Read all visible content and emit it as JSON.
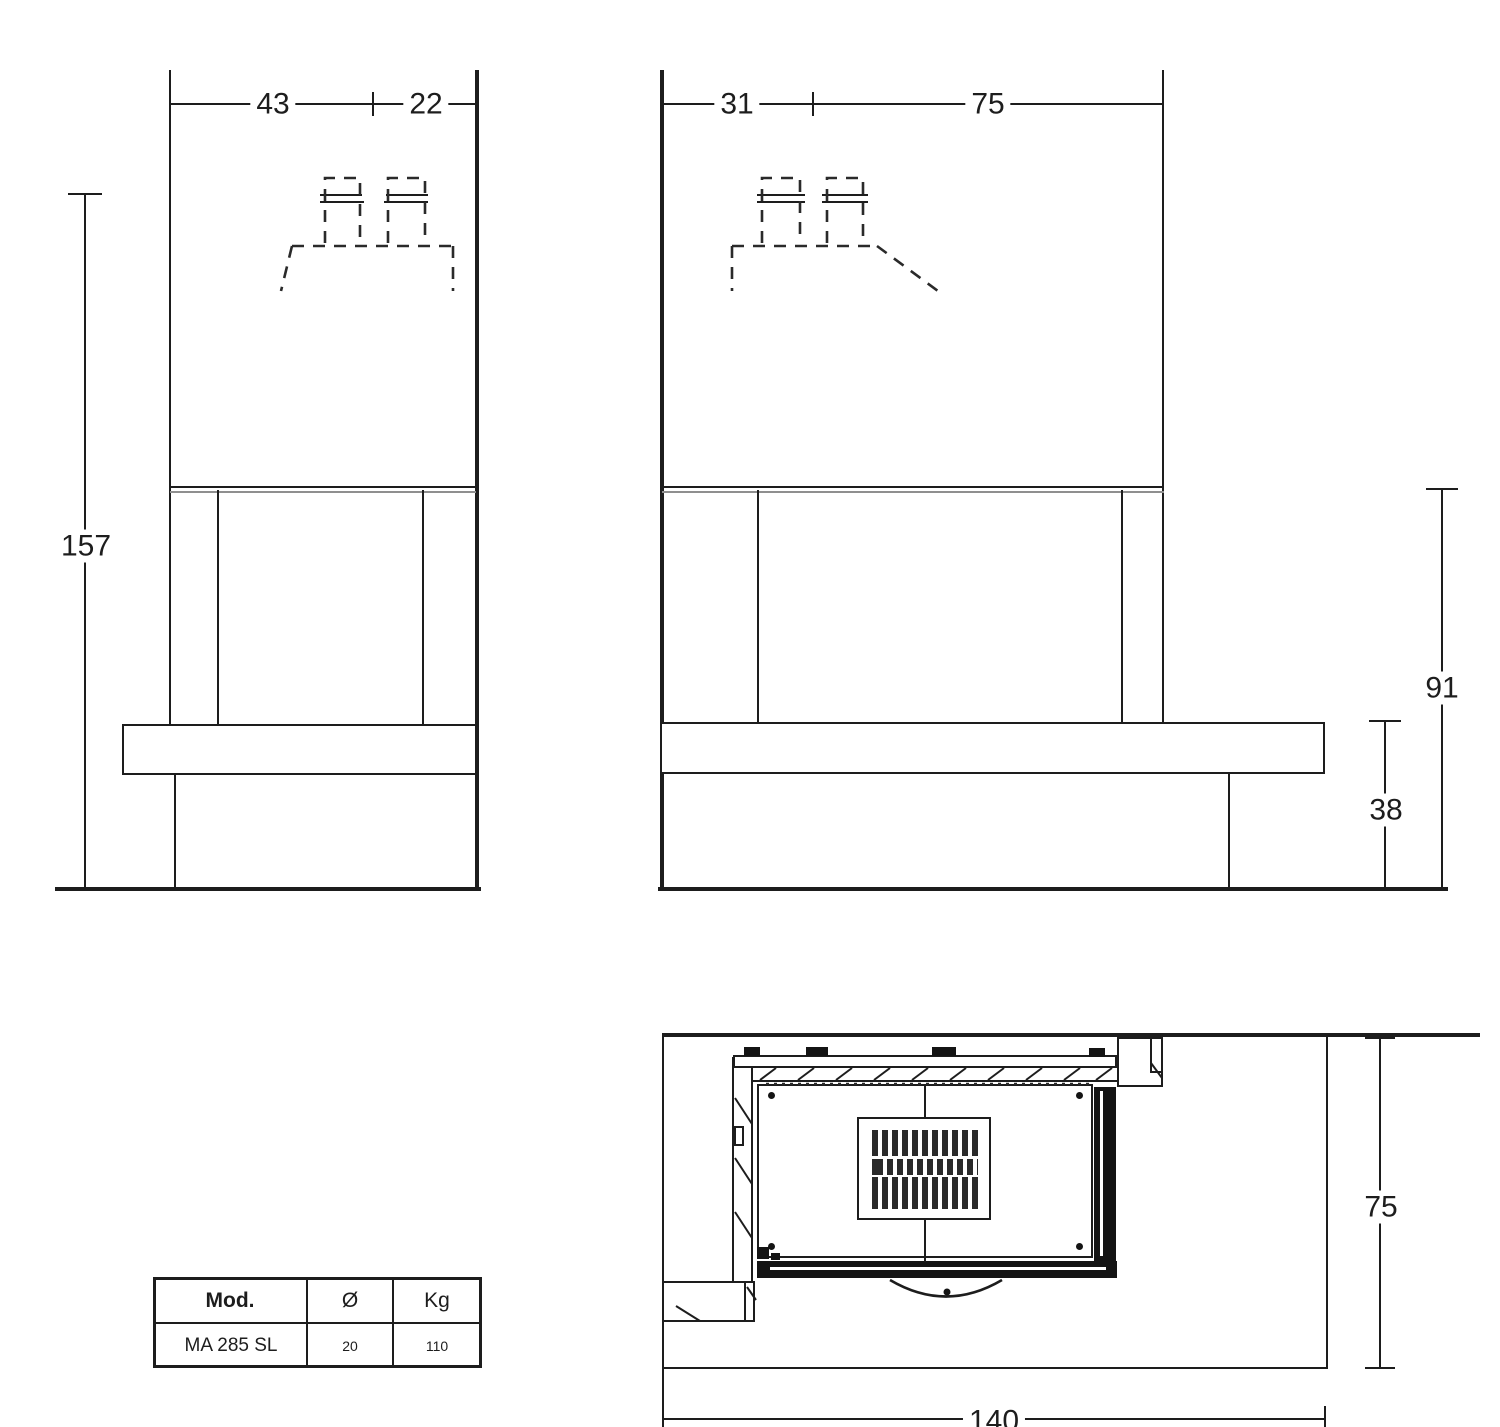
{
  "front_view": {
    "dim_top_left": "43",
    "dim_top_right": "22",
    "dim_height": "157"
  },
  "side_view": {
    "dim_top_left": "31",
    "dim_top_right": "75",
    "dim_height_firebox": "91",
    "dim_height_bench": "38"
  },
  "top_view": {
    "dim_depth": "75",
    "dim_width": "140"
  },
  "spec_table": {
    "headers": [
      "Mod.",
      "Ø",
      "Kg"
    ],
    "rows": [
      [
        "MA 285 SL",
        "20",
        "110"
      ]
    ]
  }
}
